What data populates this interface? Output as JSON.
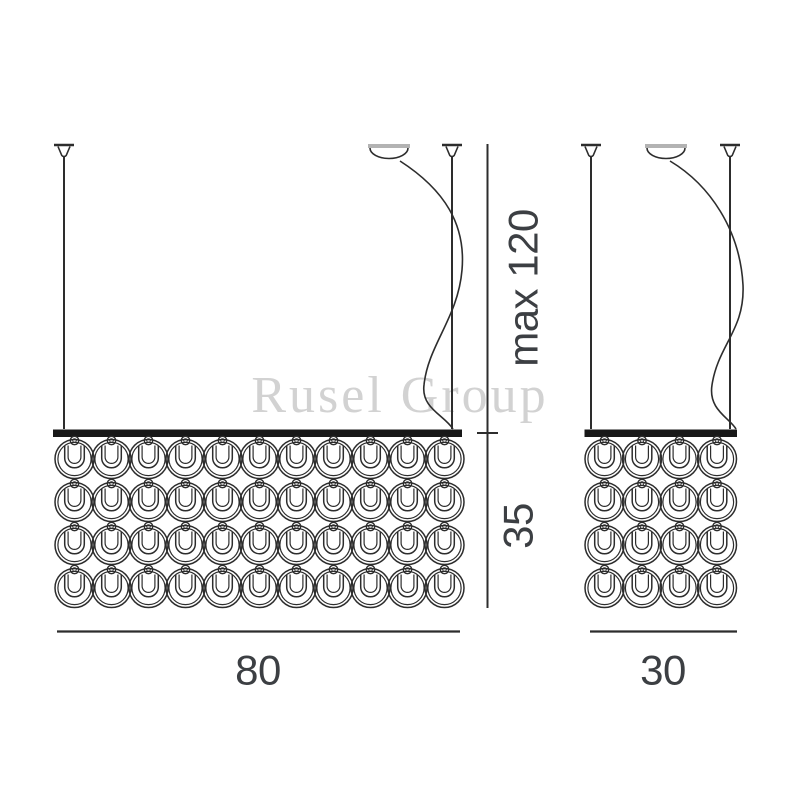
{
  "diagram": {
    "title": "pendant-chandelier-dimensional-drawing",
    "watermark": "Rusel Group",
    "dimensions": {
      "suspension_max": "max 120",
      "body_height": "35",
      "width_large": "80",
      "width_small": "30"
    },
    "fixtures": [
      {
        "id": "large",
        "width_label": "80",
        "columns": 11,
        "rows": 4
      },
      {
        "id": "small",
        "width_label": "30",
        "columns": 4,
        "rows": 4
      }
    ],
    "colors": {
      "line": "#2d2d2d",
      "bar": "#181818",
      "canopy_top": "#b3b3b3",
      "dimension_text": "#3c3f43",
      "watermark": "#d2d2d2",
      "background": "#ffffff"
    }
  }
}
